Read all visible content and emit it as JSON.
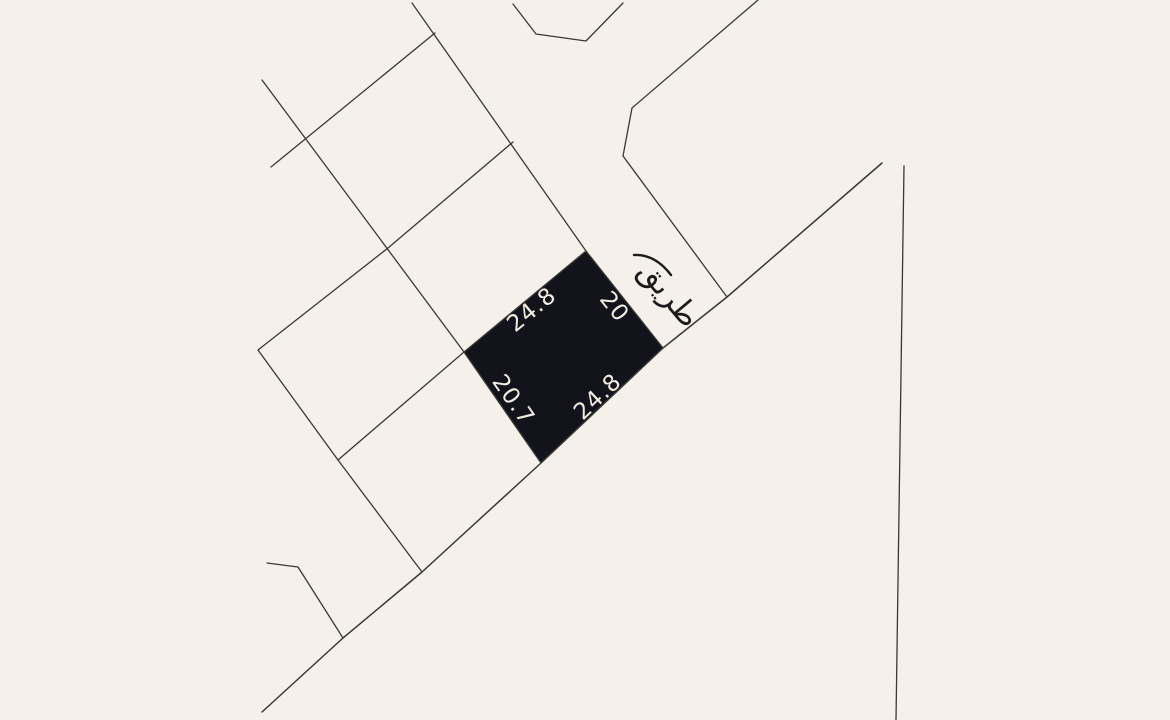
{
  "map": {
    "background_color": "#f5f0ea",
    "line_color": "#3b3834",
    "road": {
      "label": "طريق",
      "label_color": "#1b1b1b"
    },
    "parcel": {
      "fill_color": "#13131c",
      "label_color": "#f2ece1",
      "dimensions": {
        "nw_edge": "24.8",
        "ne_edge": "20",
        "sw_edge": "20.7",
        "se_edge": "24.8"
      }
    }
  }
}
